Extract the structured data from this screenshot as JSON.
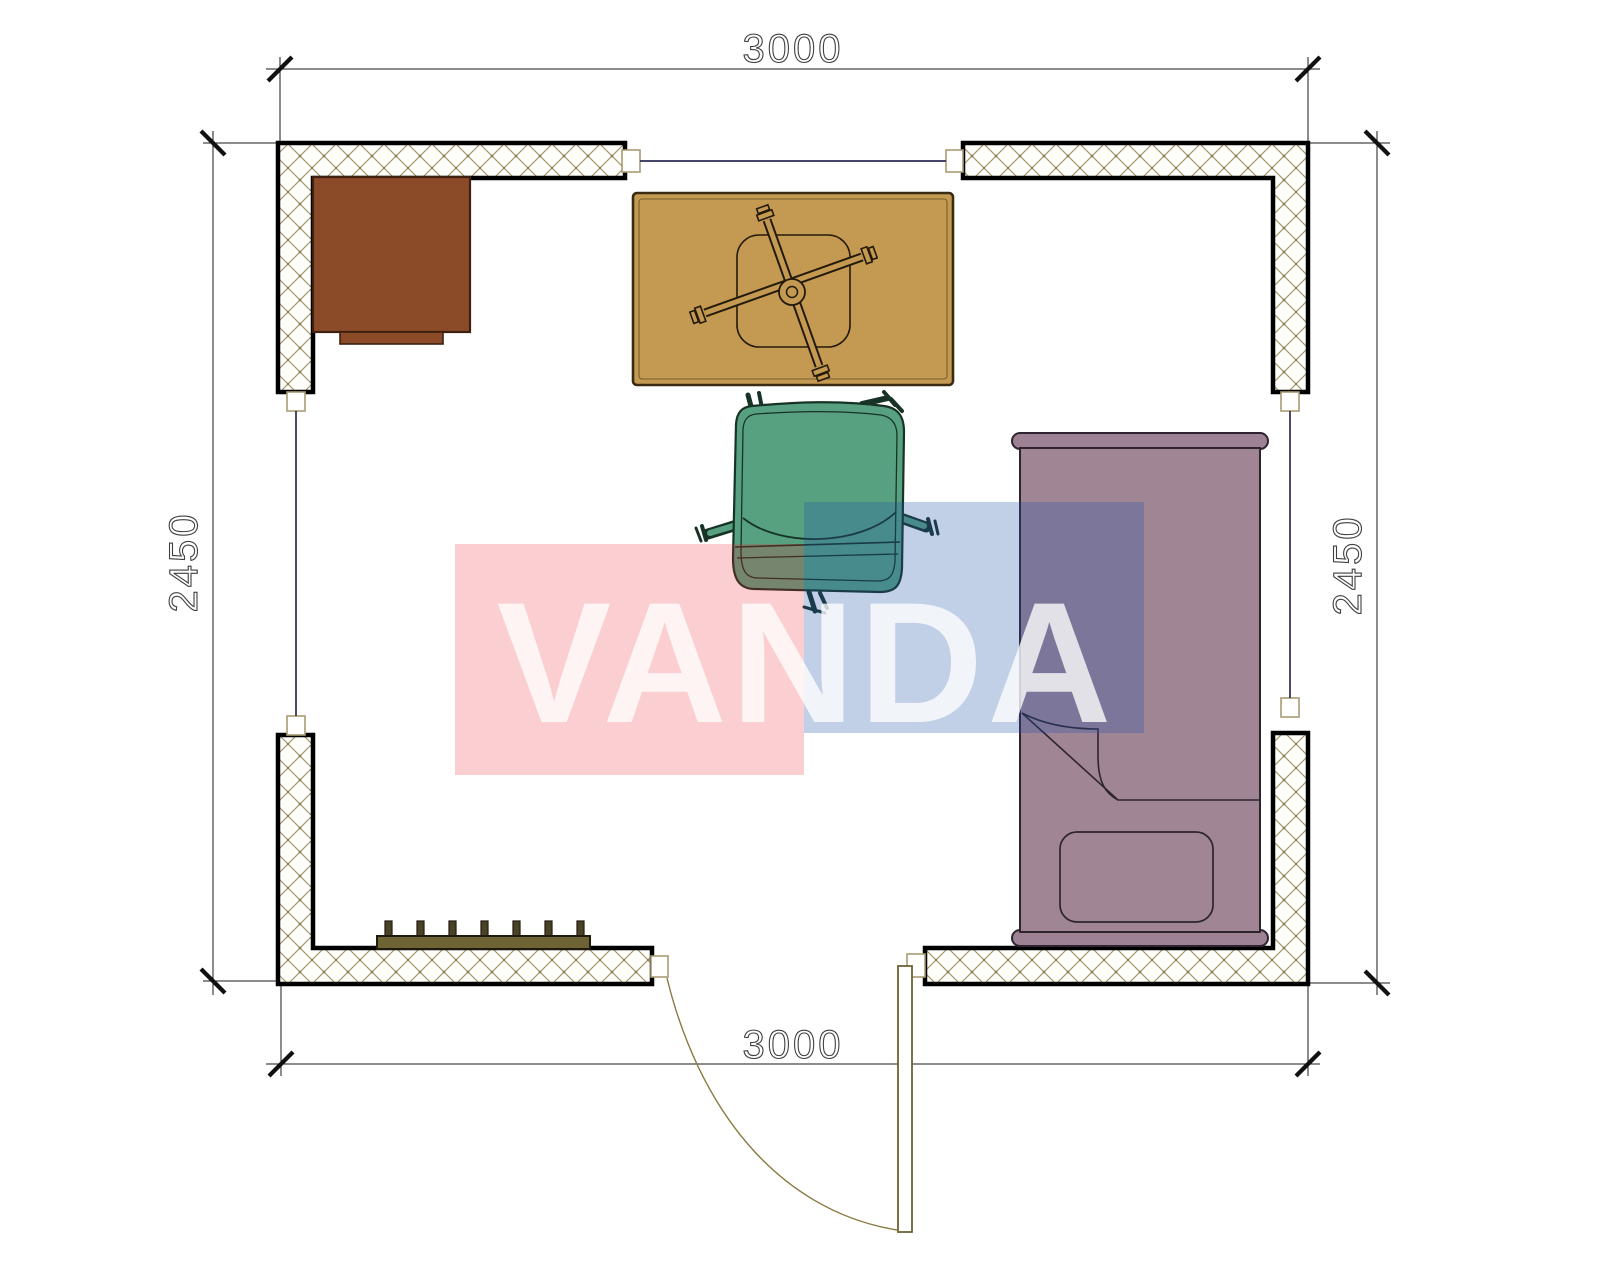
{
  "drawing": {
    "type": "floor-plan",
    "dimensions": {
      "top": "3000",
      "bottom": "3000",
      "left": "2450",
      "right": "2450"
    },
    "watermark": {
      "text": "VANDA",
      "pink": "#ED1C24",
      "blue": "#2153A8",
      "letters": "#FFFFFF"
    },
    "colors": {
      "wall_outline": "#000000",
      "hatch": "#a6996f",
      "window": "#2b2b55",
      "jamb_stroke": "#a89b72",
      "cabinet": "#8B4A28",
      "cabinet_stroke": "#3f2010",
      "desk": "#C49A52",
      "desk_stroke": "#3a2c12",
      "chair_outline": "#241a0a",
      "visitor_chair": "#57A181",
      "visitor_chair_dark": "#173326",
      "bed": "#A08595",
      "bed_rail": "#9D8294",
      "bed_line": "#2e2430",
      "radiator": "#6E6335",
      "radiator_fin": "#4A4226",
      "door": "#8a7a42",
      "dim_line": "#1a1a1a",
      "dim_text": "#3f3f3f"
    }
  }
}
